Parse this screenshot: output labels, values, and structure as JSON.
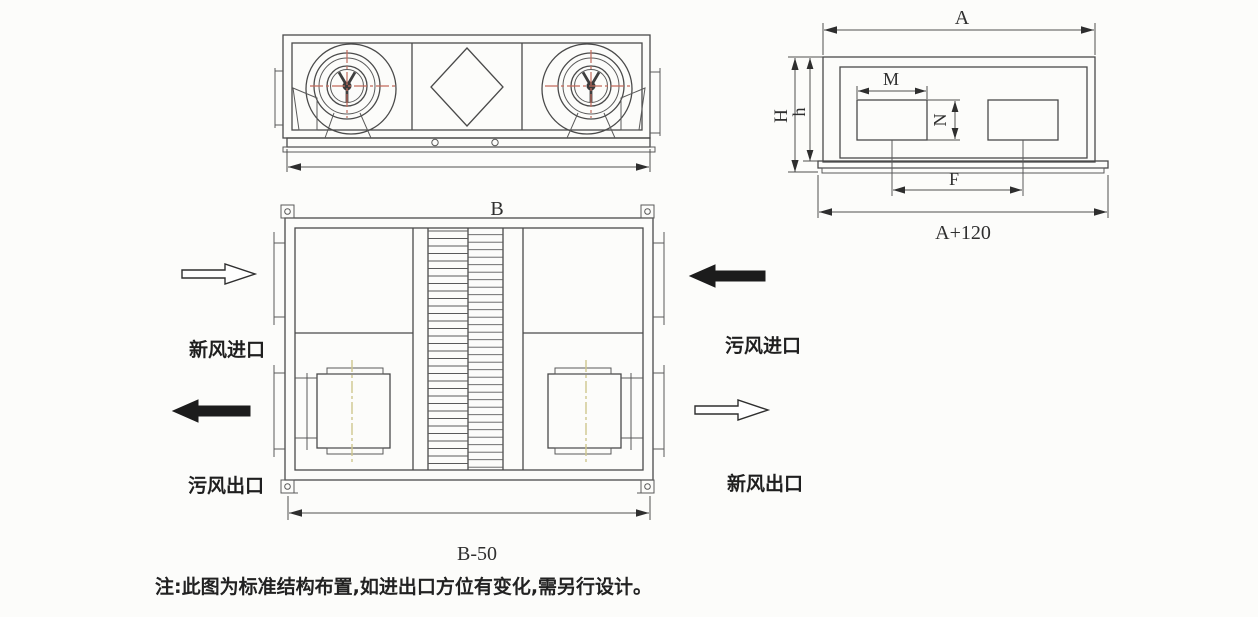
{
  "side_view": {
    "dim_a": "A",
    "dim_height_overall": "H",
    "dim_height_body": "h",
    "dim_opening_width": "M",
    "dim_opening_height": "N",
    "dim_opening_spacing": "F",
    "dim_base_width": "A+120"
  },
  "plan_view": {
    "dim_width": "B",
    "dim_base_width": "B-50"
  },
  "flow_labels": {
    "fresh_air_inlet": "新风进口",
    "foul_air_outlet": "污风出口",
    "foul_air_inlet": "污风进口",
    "fresh_air_outlet": "新风出口"
  },
  "note": {
    "text": "注:此图为标准结构布置,如进出口方位有变化,需另行设计。"
  },
  "colors": {
    "line": "#4a4a4a",
    "centerline_red": "#c16a5b",
    "centerline_yellow": "#cfc78d",
    "arrow_fill": "#1c1c1c",
    "background": "#fcfcfa"
  }
}
